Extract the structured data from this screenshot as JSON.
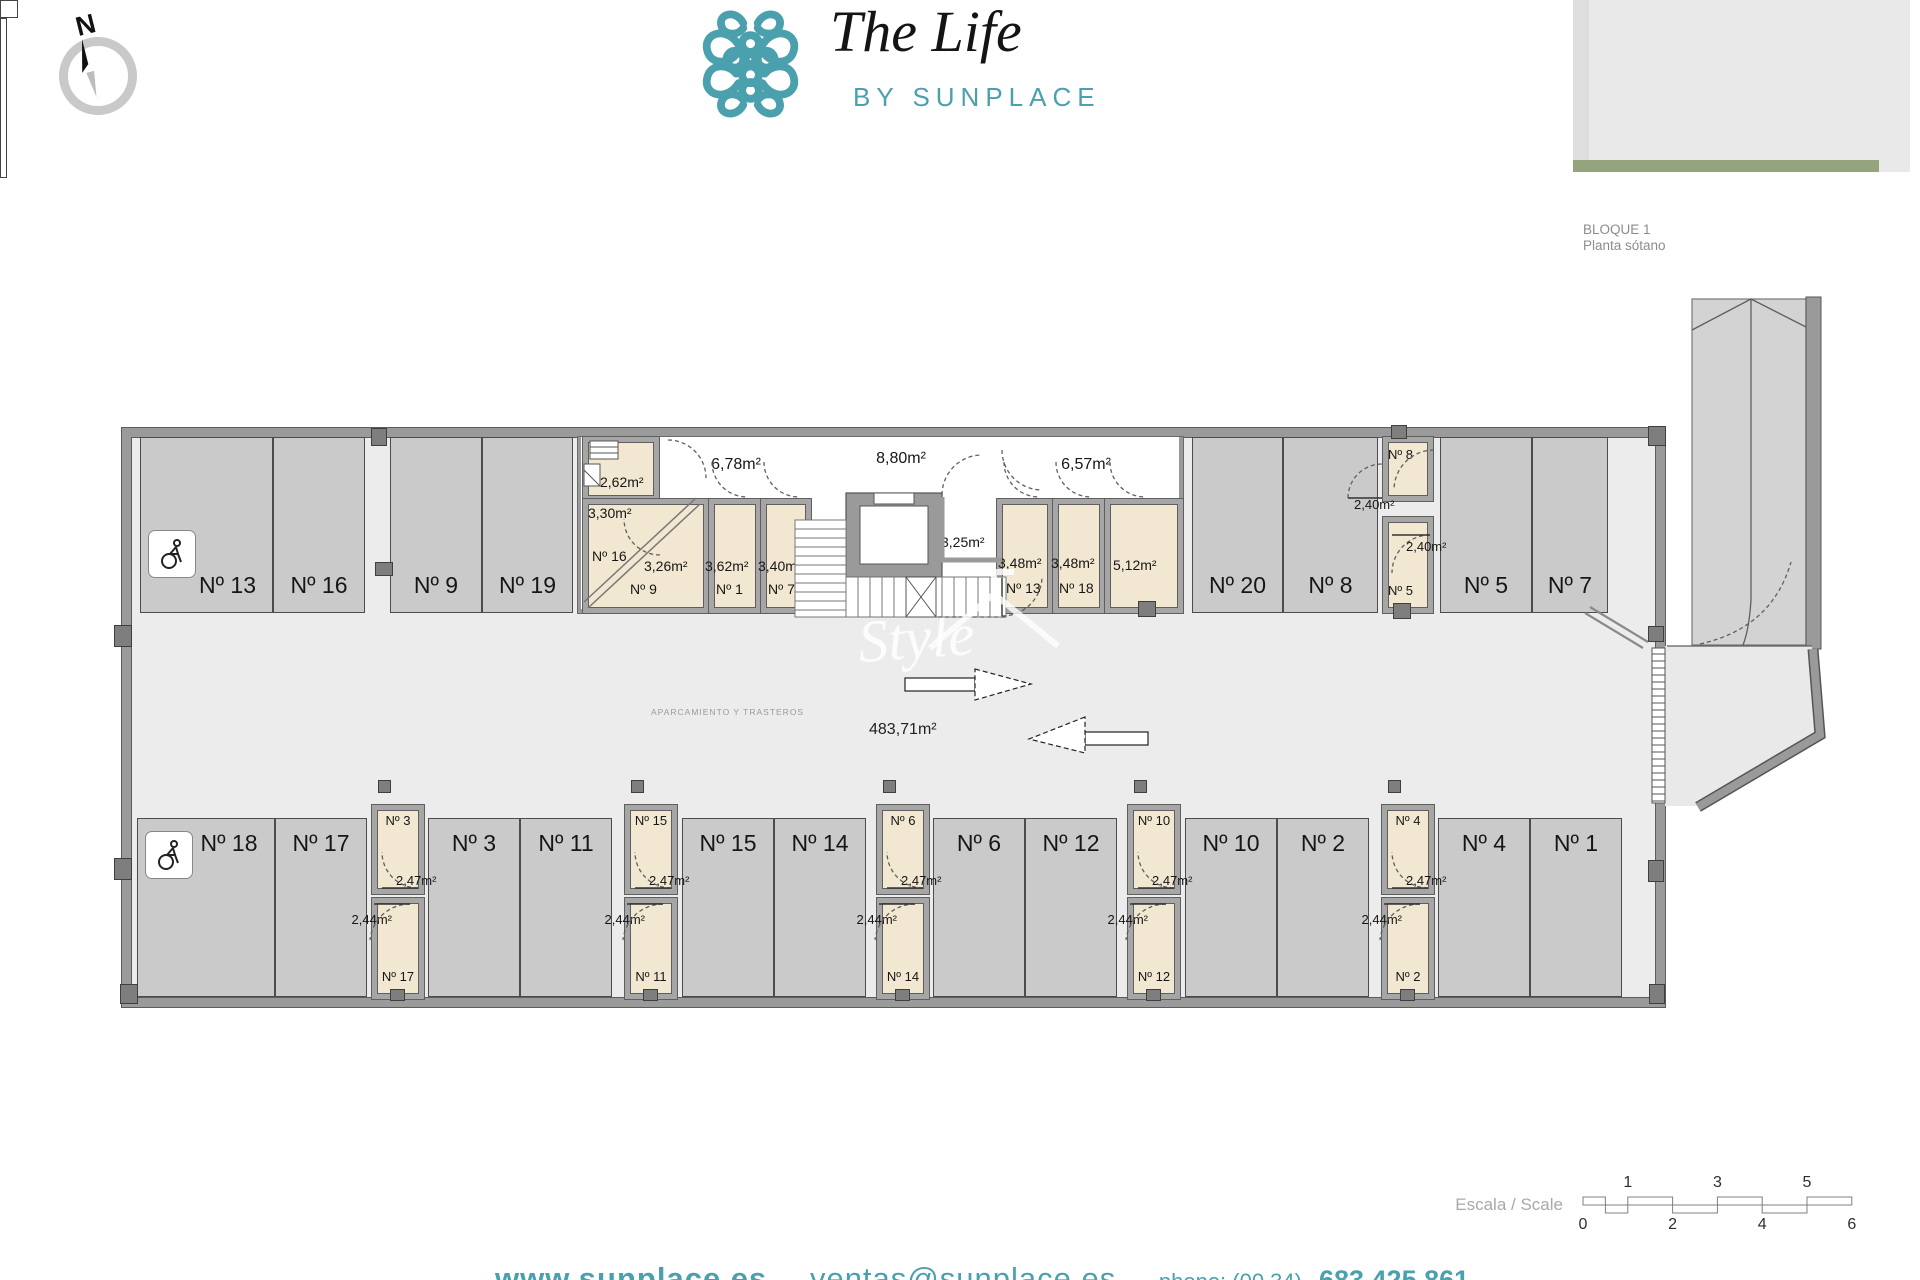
{
  "header": {
    "compass_label": "N",
    "logo": {
      "title": "The Life",
      "subtitle": "BY SUNPLACE"
    },
    "block": {
      "title": "BLOQUE 1",
      "subtitle": "Planta sótano"
    }
  },
  "plan": {
    "area_total": "483,71m²",
    "zone_label": "APARCAMIENTO Y TRASTEROS",
    "top_parking": [
      {
        "label": "Nº 13"
      },
      {
        "label": "Nº 16"
      },
      {
        "label": "Nº 9"
      },
      {
        "label": "Nº 19"
      },
      {
        "label": "Nº 20"
      },
      {
        "label": "Nº 8"
      },
      {
        "label": "Nº 5"
      },
      {
        "label": "Nº 7"
      }
    ],
    "bottom_parking": [
      {
        "label": "Nº 18"
      },
      {
        "label": "Nº 17"
      },
      {
        "label": "Nº 3"
      },
      {
        "label": "Nº 11"
      },
      {
        "label": "Nº 15"
      },
      {
        "label": "Nº 14"
      },
      {
        "label": "Nº 6"
      },
      {
        "label": "Nº 12"
      },
      {
        "label": "Nº 10"
      },
      {
        "label": "Nº 2"
      },
      {
        "label": "Nº 4"
      },
      {
        "label": "Nº 1"
      }
    ],
    "rooms": [
      {
        "area": "2,62m²"
      },
      {
        "area": "3,30m²",
        "label": "Nº 16"
      },
      {
        "area": "3,26m²",
        "label": "Nº 9"
      },
      {
        "area": "6,78m²"
      },
      {
        "area": "3,62m²",
        "label": "Nº 1"
      },
      {
        "area": "3,40m²",
        "label": "Nº 7"
      },
      {
        "area": "8,80m²"
      },
      {
        "area": "6,11m²"
      },
      {
        "area": "3,25m²"
      },
      {
        "area": "6,57m²"
      },
      {
        "area": "3,48m²",
        "label": "Nº 13"
      },
      {
        "area": "3,48m²",
        "label": "Nº 18"
      },
      {
        "area": "5,12m²"
      },
      {
        "area": "2,40m²",
        "label": "Nº 8"
      },
      {
        "area": "2,40m²",
        "label": "Nº 5"
      }
    ],
    "storage_columns": [
      {
        "top_label": "Nº 3",
        "top_area": "2,47m²",
        "bottom_area": "2,44m²",
        "bottom_label": "Nº 17"
      },
      {
        "top_label": "Nº 15",
        "top_area": "2,47m²",
        "bottom_area": "2,44m²",
        "bottom_label": "Nº 11"
      },
      {
        "top_label": "Nº 6",
        "top_area": "2,47m²",
        "bottom_area": "2,44m²",
        "bottom_label": "Nº 14"
      },
      {
        "top_label": "Nº 10",
        "top_area": "2,47m²",
        "bottom_area": "2,44m²",
        "bottom_label": "Nº 12"
      },
      {
        "top_label": "Nº 4",
        "top_area": "2,47m²",
        "bottom_area": "2,44m²",
        "bottom_label": "Nº 2"
      }
    ]
  },
  "watermark": {
    "text": "Style"
  },
  "scale_bar": {
    "label": "Escala / Scale",
    "top_numbers": [
      "1",
      "3",
      "5"
    ],
    "bottom_numbers": [
      "0",
      "2",
      "4",
      "6"
    ]
  },
  "footer": {
    "website": "www.sunplace.es",
    "separator1": "-",
    "email": "ventas@sunplace.es",
    "separator2": "-",
    "phone_prefix": "phone: (00 34)",
    "phone": "683 425 861"
  },
  "colors": {
    "teal": "#4BA0AE",
    "storage_beige": "#F2E8D2",
    "parking_gray": "#CACACA",
    "aisle_gray": "#ECECEC",
    "wall_gray": "#9A9A9A",
    "site_building_teal": "#52ACBA",
    "site_green": "#94A47C"
  }
}
